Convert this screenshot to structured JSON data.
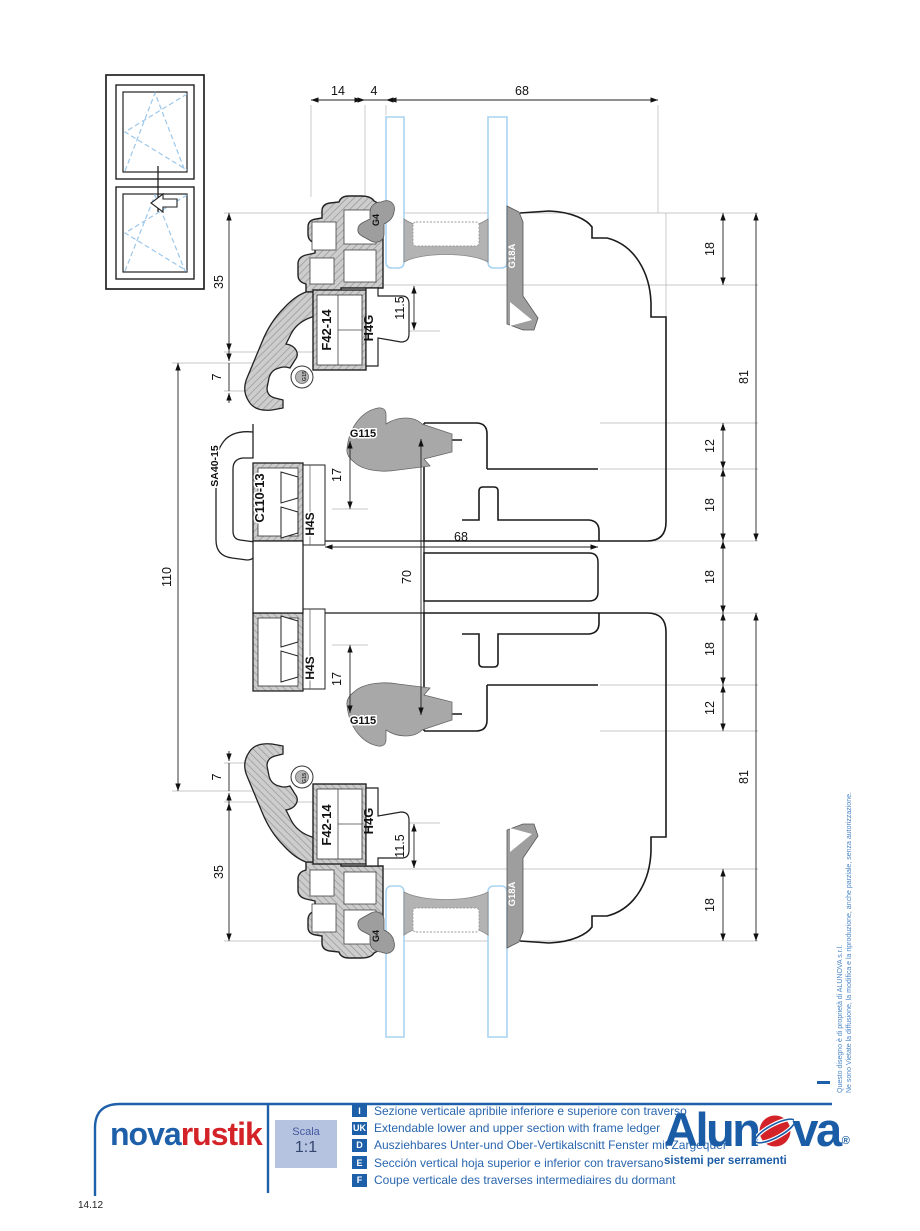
{
  "dims": {
    "top_14": "14",
    "top_4": "4",
    "top_68": "68",
    "left_35_top": "35",
    "left_7_top": "7",
    "left_110": "110",
    "left_7_bottom": "7",
    "left_35_bottom": "35",
    "glass_11_5_top": "11.5",
    "mid_17_top": "17",
    "mid_68": "68",
    "mid_70": "70",
    "mid_17_bottom": "17",
    "glass_11_5_bottom": "11.5",
    "right_18_1": "18",
    "right_12_1": "12",
    "right_18_2": "18",
    "right_18_3": "18",
    "right_18_4": "18",
    "right_12_2": "12",
    "right_18_5": "18",
    "right_81_top": "81",
    "right_81_bottom": "81"
  },
  "profiles": {
    "gasket_g4_top": "G4",
    "gasket_g18a_top": "G18A",
    "frame_f42_top": "F42-14",
    "bead_h4g_top": "H4G",
    "gasket_g15_top": "G15",
    "clip_sa40": "SA40-15",
    "transom_c110": "C110-13",
    "clip_h4s_top": "H4S",
    "gasket_g115_top": "G115",
    "gasket_g115_bottom": "G115",
    "clip_h4s_bottom": "H4S",
    "frame_f42_bottom": "F42-14",
    "bead_h4g_bottom": "H4G",
    "gasket_g4_bottom": "G4",
    "gasket_g18a_bottom": "G18A",
    "gasket_g15_bottom": "G15"
  },
  "legend": {
    "series_name_part1": "nova",
    "series_name_part2": "rustik",
    "scale_label": "Scala",
    "scale_value": "1:1",
    "rows": [
      {
        "code": "I",
        "text": "Sezione verticale apribile inferiore e superiore con traverso"
      },
      {
        "code": "UK",
        "text": "Extendable lower and upper section with frame ledger"
      },
      {
        "code": "D",
        "text": "Ausziehbares Unter-und Ober-Vertikalscnitt Fenster mit Zargequer"
      },
      {
        "code": "E",
        "text": "Sección vertical hoja superior e inferior con traversano"
      },
      {
        "code": "F",
        "text": "Coupe verticale des traverses intermediaires du dormant"
      }
    ],
    "brand_part1": "Alun",
    "brand_part2": "va",
    "registered": "®",
    "brand_tagline": "sistemi per serramenti"
  },
  "copyright": {
    "line1": "Questo disegno è di proprietà di ALUNOVA s.r.l.",
    "line2": "Ne sono Vietate la diffusione, la modifica e la riproduzione, anche parziale, senza autorizzazione."
  },
  "page_number": "14.12"
}
